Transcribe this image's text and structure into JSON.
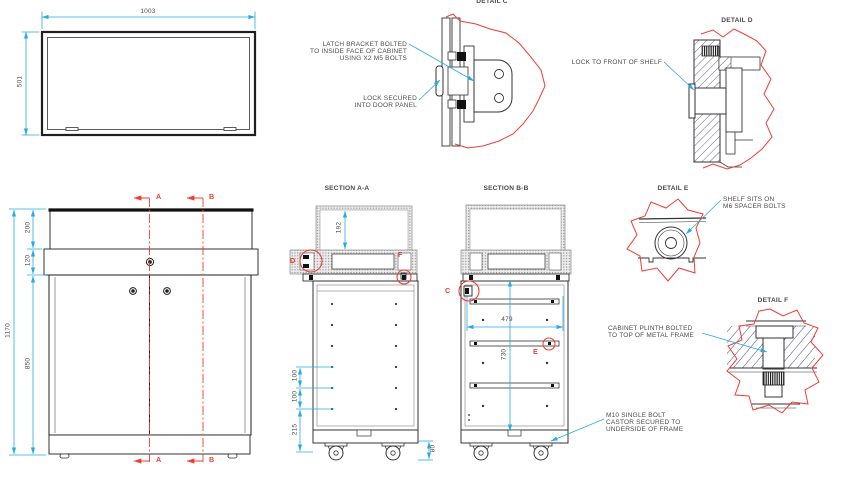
{
  "colors": {
    "dimension_blue": "#29ABE2",
    "section_red": "#EF3E33",
    "line_dark": "#333333"
  },
  "plan": {
    "dim_width": "1003",
    "dim_depth": "501"
  },
  "elevation": {
    "dim_total": "1170",
    "dim_top": "200",
    "dim_band": "120",
    "dim_doors": "850",
    "cut_a": "A",
    "cut_b": "B"
  },
  "section_aa": {
    "title": "SECTION A-A",
    "dim_shelf": "192",
    "dim_pitch1": "100",
    "dim_pitch2": "100",
    "dim_bottom": "215",
    "dim_castor": "80",
    "detail_d": "D",
    "detail_f": "F"
  },
  "section_bb": {
    "title": "SECTION B-B",
    "dim_width": "479",
    "dim_height": "730",
    "detail_c": "C",
    "detail_e": "E"
  },
  "detail_c": {
    "title": "DETAIL C",
    "note_latch": "LATCH BRACKET BOLTED\nTO INSIDE FACE OF CABINET\nUSING X2 M5 BOLTS",
    "note_lock": "LOCK SECURED\nINTO DOOR PANEL"
  },
  "detail_d": {
    "title": "DETAIL D",
    "note": "LOCK TO FRONT OF SHELF"
  },
  "detail_e": {
    "title": "DETAIL E",
    "note": "SHELF SITS ON\nM6 SPACER BOLTS"
  },
  "detail_f": {
    "title": "DETAIL F",
    "note_plinth": "CABINET PLINTH BOLTED\nTO TOP OF METAL FRAME",
    "note_castor": "M10 SINGLE BOLT\nCASTOR SECURED TO\nUNDERSIDE OF FRAME"
  }
}
